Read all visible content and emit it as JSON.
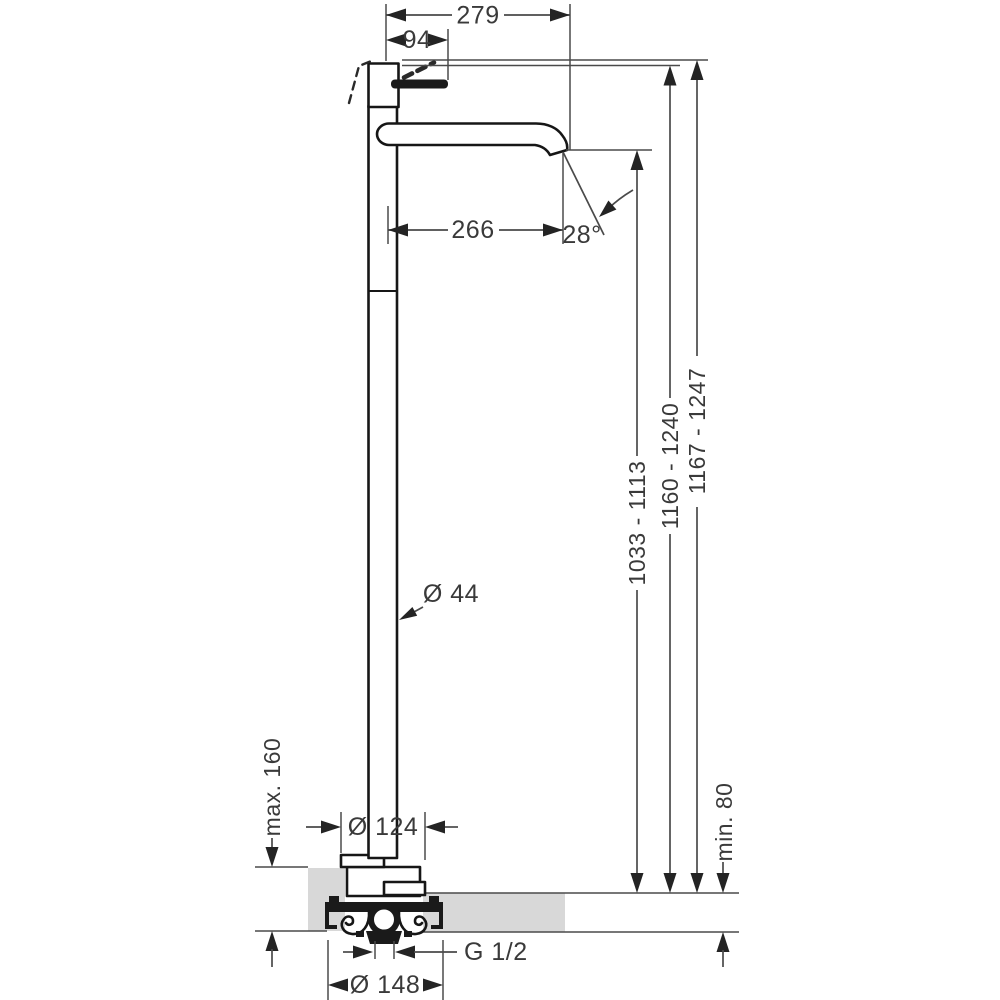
{
  "drawing": {
    "type": "technical-dimension-drawing",
    "subject": "floor-standing single-lever basin mixer, side elevation with installation floor section"
  },
  "labels": {
    "spout_projection_total": "279",
    "handle_projection": "94",
    "spout_reach": "266",
    "spout_angle": "28°",
    "riser_diameter": "Ø 44",
    "outlet_height_range": "1033 - 1113",
    "body_height_range": "1160 - 1240",
    "total_height_range": "1167 - 1247",
    "floor_buildup_max": "max. 160",
    "escutcheon_diameter": "Ø 124",
    "floor_buildup_min": "min. 80",
    "connection_thread": "G 1/2",
    "flange_diameter": "Ø 148"
  },
  "colors": {
    "background": "#ffffff",
    "object_outline": "#161616",
    "dimension_line": "#4a4a4a",
    "arrow_fill": "#242424",
    "text": "#3a3a3a",
    "floor_fill": "#d8d8d8"
  }
}
